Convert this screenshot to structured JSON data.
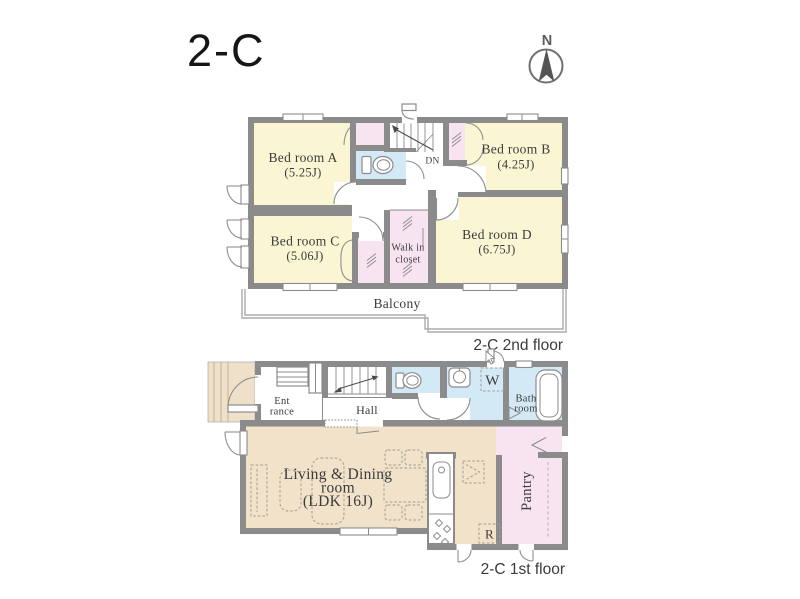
{
  "title": "2-C",
  "compass": {
    "label": "N"
  },
  "floor2": {
    "caption": "2-C 2nd floor",
    "rooms": {
      "bedroomA": {
        "name": "Bed room A",
        "size": "(5.25J)"
      },
      "bedroomB": {
        "name": "Bed room B",
        "size": "(4.25J)"
      },
      "bedroomC": {
        "name": "Bed room C",
        "size": "(5.06J)"
      },
      "bedroomD": {
        "name": "Bed room D",
        "size": "(6.75J)"
      },
      "walkInCloset": {
        "line1": "Walk in",
        "line2": "closet"
      },
      "balcony": {
        "name": "Balcony"
      },
      "stairs": {
        "label": "DN"
      }
    }
  },
  "floor1": {
    "caption": "2-C 1st floor",
    "rooms": {
      "entrance": {
        "line1": "Ent",
        "line2": "rance"
      },
      "hall": {
        "name": "Hall"
      },
      "washerBox": {
        "label": "W"
      },
      "bathroom": {
        "line1": "Bath",
        "line2": "room"
      },
      "ldk": {
        "line1": "Living & Dining",
        "line2": "room",
        "line3": "(LDK 16J)"
      },
      "pantry": {
        "name": "Pantry"
      },
      "refrigerator": {
        "label": "R"
      }
    }
  },
  "colors": {
    "wall": "#8b8b8b",
    "bedroom_yellow": "#faf6d4",
    "closet_pink": "#f8e3f0",
    "water_blue": "#d3eaf6",
    "ldk_tan": "#f1e2c9",
    "porch_tan": "#efe0c9",
    "balcony_line": "#ababab",
    "label_text": "#3b3b3b"
  }
}
